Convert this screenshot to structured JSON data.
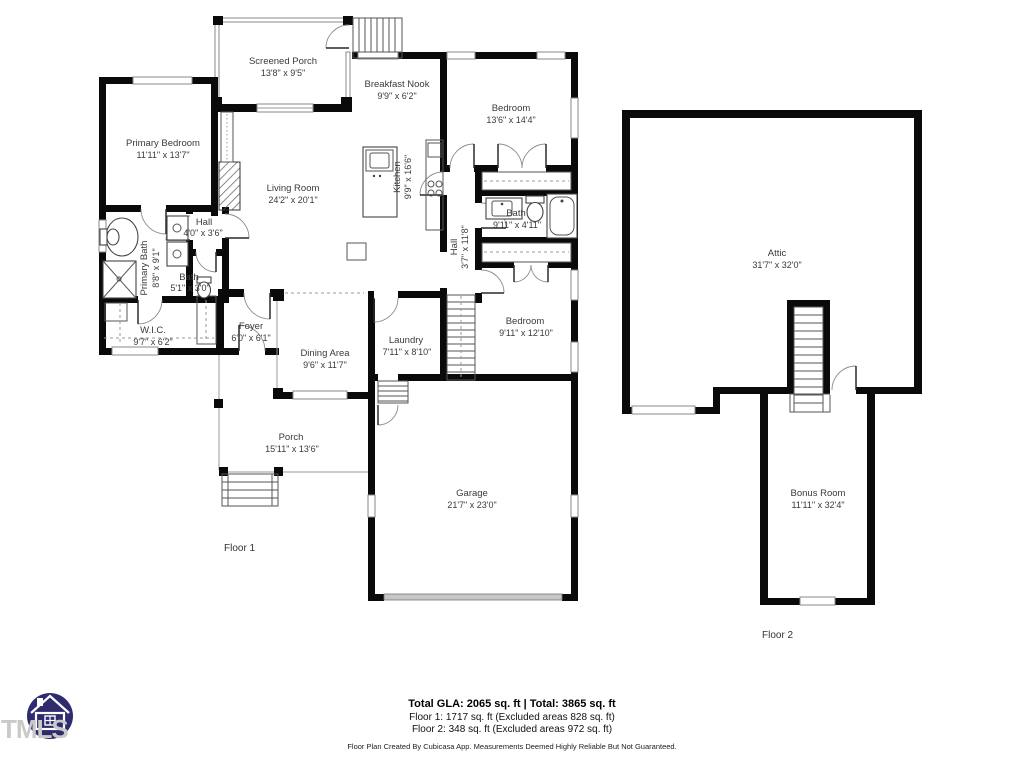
{
  "floor1": {
    "label": "Floor 1",
    "rooms": {
      "screened_porch": {
        "name": "Screened Porch",
        "dims": "13'8\" x 9'5\""
      },
      "primary_bedroom": {
        "name": "Primary Bedroom",
        "dims": "11'11\" x 13'7\""
      },
      "breakfast_nook": {
        "name": "Breakfast Nook",
        "dims": "9'9\" x 6'2\""
      },
      "bedroom_upper": {
        "name": "Bedroom",
        "dims": "13'6\" x 14'4\""
      },
      "living_room": {
        "name": "Living Room",
        "dims": "24'2\" x 20'1\""
      },
      "kitchen": {
        "name": "Kitchen",
        "dims": "9'9\" x 16'6\""
      },
      "bath": {
        "name": "Bath",
        "dims": "9'11\" x 4'11\""
      },
      "hall": {
        "name": "Hall",
        "dims": "3'7\" x 11'8\""
      },
      "hall_small": {
        "name": "Hall",
        "dims": "4'0\" x 3'6\""
      },
      "primary_bath": {
        "name": "Primary Bath",
        "dims": "8'8\" x 9'1\""
      },
      "bath_small": {
        "name": "Bath",
        "dims": "5'1\" x 3'0\""
      },
      "wic": {
        "name": "W.I.C.",
        "dims": "9'7\" x 6'2\""
      },
      "foyer": {
        "name": "Foyer",
        "dims": "6'0\" x 6'1\""
      },
      "dining_area": {
        "name": "Dining Area",
        "dims": "9'6\" x 11'7\""
      },
      "laundry": {
        "name": "Laundry",
        "dims": "7'11\" x 8'10\""
      },
      "bedroom_lower": {
        "name": "Bedroom",
        "dims": "9'11\" x 12'10\""
      },
      "porch": {
        "name": "Porch",
        "dims": "15'11\" x 13'6\""
      },
      "garage": {
        "name": "Garage",
        "dims": "21'7\" x 23'0\""
      }
    }
  },
  "floor2": {
    "label": "Floor 2",
    "rooms": {
      "attic": {
        "name": "Attic",
        "dims": "31'7\" x 32'0\""
      },
      "bonus_room": {
        "name": "Bonus Room",
        "dims": "11'11\" x 32'4\""
      }
    }
  },
  "footer": {
    "total_line": "Total GLA: 2065 sq. ft | Total: 3865 sq. ft",
    "floor1_line": "Floor 1: 1717 sq. ft (Excluded areas 828 sq. ft)",
    "floor2_line": "Floor 2: 348 sq. ft (Excluded areas 972 sq. ft)",
    "disclaimer": "Floor Plan Created By Cubicasa App. Measurements Deemed Highly Reliable But Not Guaranteed."
  },
  "logo": {
    "text": "TMLS",
    "circle_color": "#2e2c6f",
    "text_color": "#c9c9c9"
  },
  "colors": {
    "wall": "#0a0a0a",
    "background": "#ffffff",
    "garage_door": "#c6c6c6"
  }
}
